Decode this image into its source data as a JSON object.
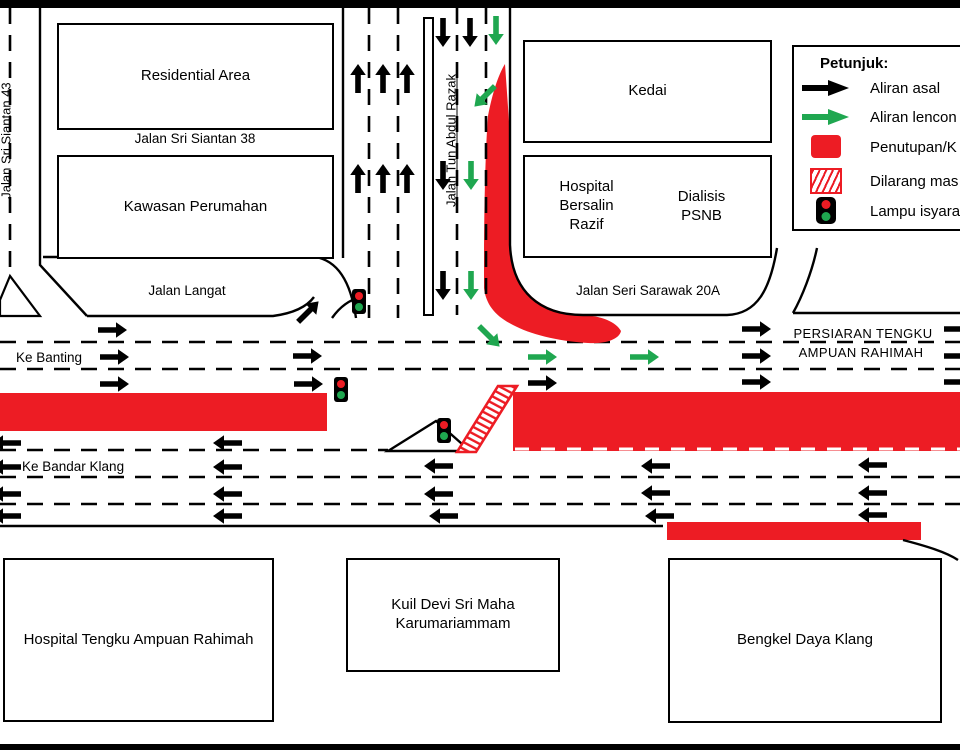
{
  "legend": {
    "title": "Petunjuk:",
    "items": [
      {
        "icon": "original-flow-arrow-icon",
        "label": "Aliran asal"
      },
      {
        "icon": "diverted-flow-arrow-icon",
        "label": "Aliran lencon"
      },
      {
        "icon": "closure-box-icon",
        "label": "Penutupan/K"
      },
      {
        "icon": "no-entry-hatch-icon",
        "label": "Dilarang mas"
      },
      {
        "icon": "traffic-light-icon",
        "label": "Lampu isyara"
      }
    ]
  },
  "buildings": {
    "residential_area": "Residential Area",
    "kawasan_perumahan": "Kawasan Perumahan",
    "kedai": "Kedai",
    "hospital_bersalin_razif": "Hospital Bersalin Razif",
    "dialisis_psnb": "Dialisis PSNB",
    "hospital_tengku_ampuan_rahimah": "Hospital Tengku Ampuan Rahimah",
    "kuil_devi": "Kuil Devi Sri Maha Karumariammam",
    "bengkel_daya_klang": "Bengkel Daya Klang"
  },
  "roads": {
    "jalan_sri_siantan_43": "Jalan Sri Siantan 43",
    "jalan_sri_siantan_38": "Jalan Sri Siantan 38",
    "jalan_langat": "Jalan Langat",
    "jalan_tun_abdul_razak": "Jalan Tun Abdul Razak",
    "jalan_seri_sarawak_20a": "Jalan Seri Sarawak 20A",
    "persiaran_line1": "PERSIARAN TENGKU",
    "persiaran_line2": "AMPUAN RAHIMAH",
    "ke_banting": "Ke Banting",
    "ke_bandar_klang": "Ke Bandar Klang"
  },
  "colors": {
    "closure_red": "#ED1C24",
    "diversion_green": "#1FA750",
    "line_black": "#000000"
  },
  "closures": [
    {
      "x": 0,
      "y": 393,
      "w": 327,
      "h": 38
    },
    {
      "x": 513,
      "y": 392,
      "w": 447,
      "h": 59
    },
    {
      "x": 667,
      "y": 522,
      "w": 254,
      "h": 18
    }
  ],
  "no_entry_zone": {
    "points": "457,452 498,386 517,386 476,452"
  },
  "traffic_lights": [
    {
      "x": 352,
      "y": 289
    },
    {
      "x": 334,
      "y": 377
    },
    {
      "x": 437,
      "y": 418
    }
  ],
  "flows": {
    "original": [
      [
        358,
        79,
        "up"
      ],
      [
        383,
        79,
        "up"
      ],
      [
        407,
        79,
        "up"
      ],
      [
        358,
        179,
        "up"
      ],
      [
        383,
        179,
        "up"
      ],
      [
        407,
        179,
        "up"
      ],
      [
        443,
        32,
        "down"
      ],
      [
        470,
        32,
        "down"
      ],
      [
        443,
        175,
        "down"
      ],
      [
        443,
        285,
        "down"
      ],
      [
        308,
        312,
        "ne"
      ],
      [
        112,
        330,
        "right"
      ],
      [
        114,
        357,
        "right"
      ],
      [
        114,
        384,
        "right"
      ],
      [
        307,
        356,
        "right"
      ],
      [
        308,
        384,
        "right"
      ],
      [
        542,
        383,
        "right"
      ],
      [
        756,
        329,
        "right"
      ],
      [
        756,
        356,
        "right"
      ],
      [
        756,
        382,
        "right"
      ],
      [
        958,
        329,
        "right"
      ],
      [
        958,
        356,
        "right"
      ],
      [
        958,
        382,
        "right"
      ],
      [
        228,
        443,
        "left"
      ],
      [
        7,
        443,
        "left"
      ],
      [
        228,
        467,
        "left"
      ],
      [
        7,
        467,
        "left"
      ],
      [
        439,
        466,
        "left"
      ],
      [
        656,
        466,
        "left"
      ],
      [
        873,
        465,
        "left"
      ],
      [
        228,
        494,
        "left"
      ],
      [
        7,
        494,
        "left"
      ],
      [
        439,
        494,
        "left"
      ],
      [
        656,
        493,
        "left"
      ],
      [
        873,
        493,
        "left"
      ],
      [
        228,
        516,
        "left"
      ],
      [
        7,
        516,
        "left"
      ],
      [
        444,
        516,
        "left"
      ],
      [
        660,
        516,
        "left"
      ],
      [
        873,
        515,
        "left"
      ]
    ],
    "diverted": [
      [
        496,
        30,
        "down"
      ],
      [
        471,
        175,
        "down"
      ],
      [
        471,
        285,
        "down"
      ],
      [
        485,
        96,
        "sw"
      ],
      [
        489,
        336,
        "se"
      ],
      [
        542,
        357,
        "right"
      ],
      [
        644,
        357,
        "right"
      ]
    ]
  }
}
